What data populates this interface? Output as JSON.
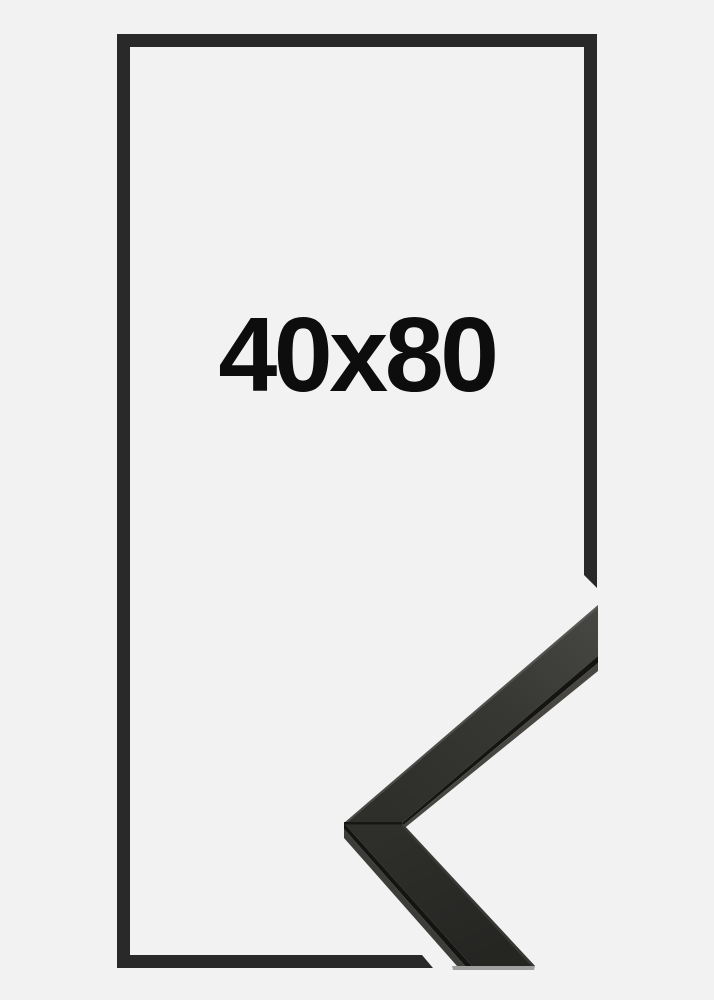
{
  "size_label": "40x80",
  "colors": {
    "background": "#f2f2f3",
    "frame_outline": "#29292a",
    "label_text": "#0d0d0d",
    "moulding_front": "#2e2e2b",
    "moulding_edge_dark": "#141412",
    "moulding_underside": "#474641",
    "moulding_side": "#3c3c38",
    "moulding_seam": "#161614",
    "moulding_outer_highlight": "#6f6f6a",
    "moulding_bottom_strip": "#909090"
  }
}
